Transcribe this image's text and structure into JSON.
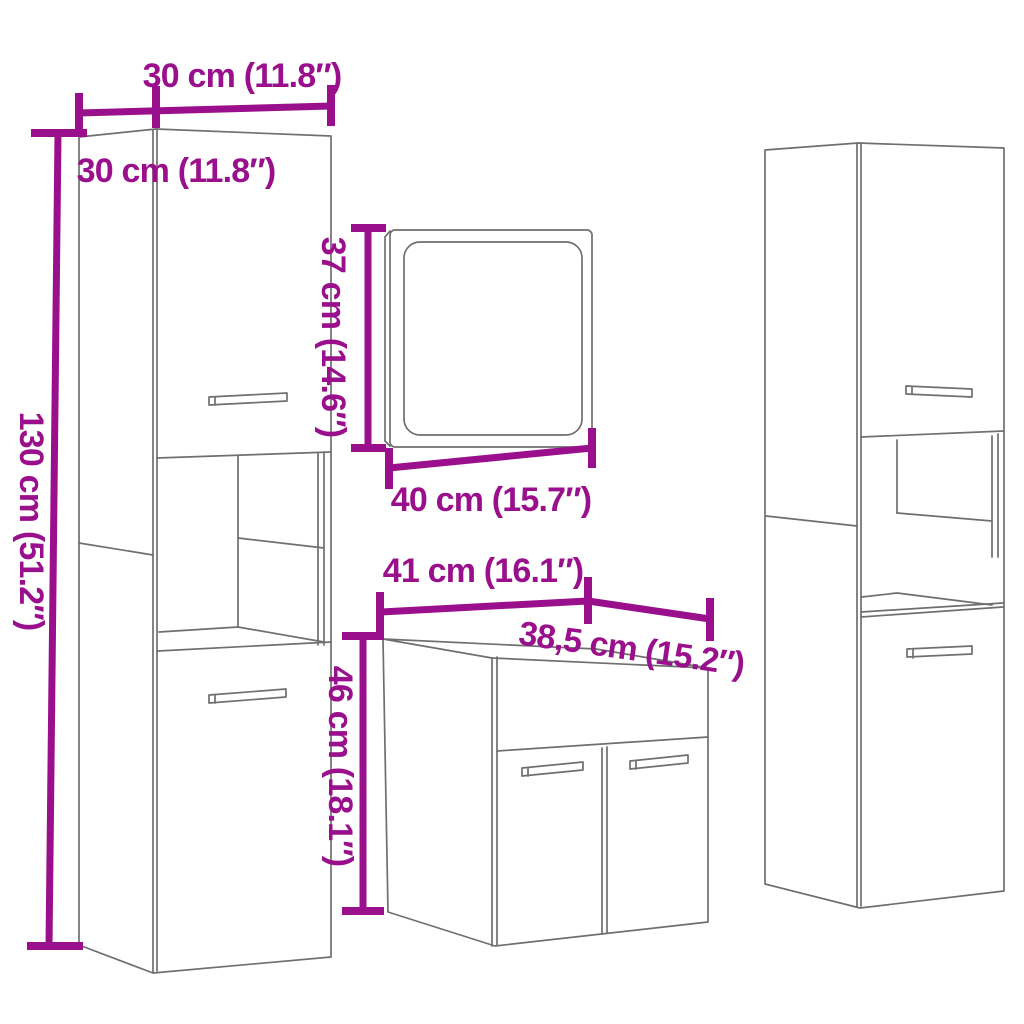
{
  "diagram": {
    "kind": "furniture-dimension-line-drawing",
    "subject": "4-piece bathroom furniture set (two tall cabinets, mirror, sink cabinet)"
  },
  "colors": {
    "dimension_accent": "#9A0F8C",
    "line_art": "#6F6F6F",
    "background": "#FFFFFF"
  },
  "labels": {
    "cabinet_width": "30 cm (11.8″)",
    "cabinet_depth": "30 cm (11.8″)",
    "cabinet_height": "130 cm (51.2″)",
    "mirror_height": "37 cm (14.6″)",
    "mirror_width": "40 cm (15.7″)",
    "sink_width": "41 cm (16.1″)",
    "sink_depth": "38,5 cm (15.2″)",
    "sink_height": "46 cm (18.1″)"
  }
}
